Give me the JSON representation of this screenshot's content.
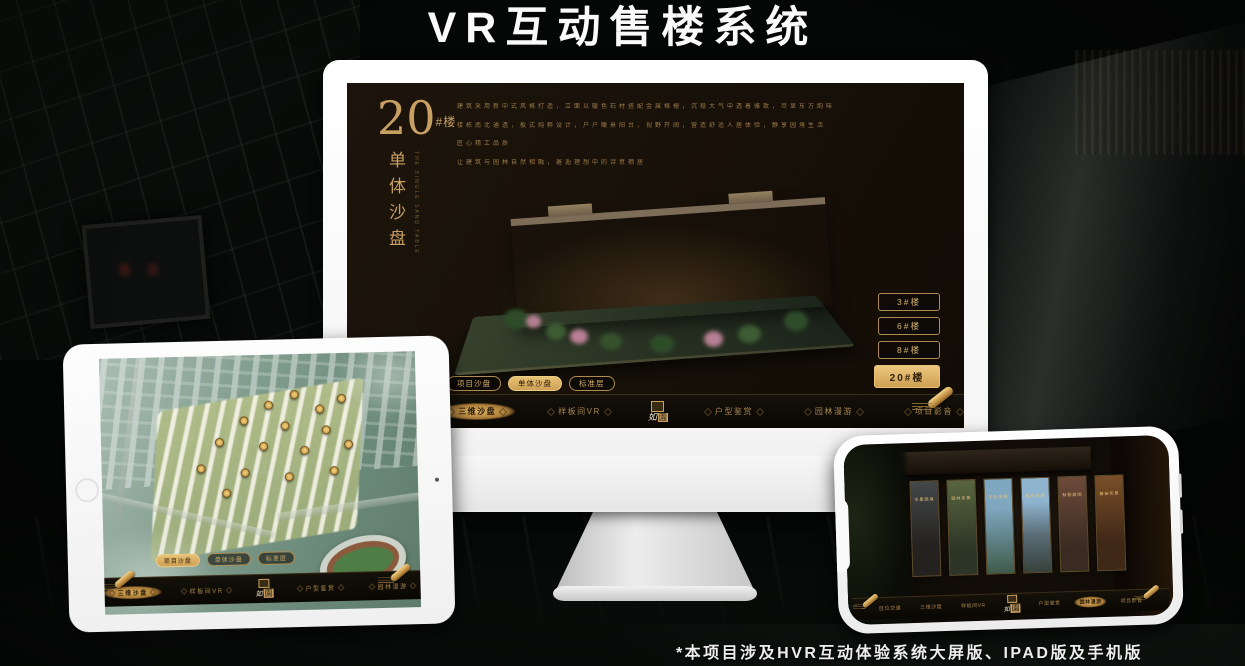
{
  "page": {
    "title": "VR互动售楼系统",
    "footnote": "*本项目涉及HVR互动体验系统大屏版、IPAD版及手机版"
  },
  "colors": {
    "gold": "#c9a063",
    "gold_bright": "#e7c175",
    "screen_bg": "#1a130c",
    "bezel_white": "#f6f6f6"
  },
  "nav": {
    "items": [
      "区位交通",
      "三维沙盘",
      "样板间VR",
      "户型鉴赏",
      "园林漫游",
      "项目影音"
    ]
  },
  "subtabs": {
    "items": [
      "项目沙盘",
      "单体沙盘",
      "标准层"
    ]
  },
  "logo": {
    "name_left": "如",
    "name_right": "園"
  },
  "desktop": {
    "title_number": "20",
    "title_suffix": "#楼",
    "title_vertical": "单体沙盘",
    "title_english": "THE SINGLE SAND TABLE",
    "description_lines": [
      "建筑采用新中式风格打造，立面以暖色石材搭配金属格栅，沉稳大气中透着雅致，尽显东方韵味",
      "楼栋南北通透，板式纯粹设计，户户瞰景阳台，视野开阔，营造舒适人居体验，静享园境生活",
      "匠心精工品质",
      "让建筑与园林自然相融，邂逅理想中的诗意栖居"
    ],
    "floor_buttons": [
      "3#楼",
      "6#楼",
      "8#楼",
      "20#楼"
    ],
    "active_floor": "20#楼",
    "active_subtab": "单体沙盘",
    "active_nav": "三维沙盘"
  },
  "tablet": {
    "active_subtab": "项目沙盘",
    "active_nav": "三维沙盘"
  },
  "phone": {
    "active_nav": "园林漫游",
    "panels": [
      {
        "label": "水墨园境"
      },
      {
        "label": "园林实景"
      },
      {
        "label": "天际景观"
      },
      {
        "label": "楼栋风貌"
      },
      {
        "label": "秋韵庭院"
      },
      {
        "label": "精装实景"
      }
    ]
  }
}
